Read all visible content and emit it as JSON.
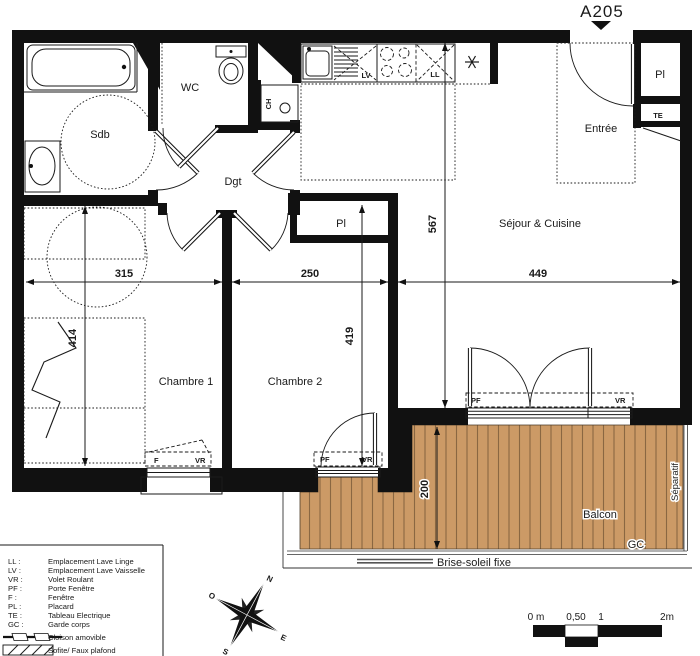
{
  "title": "A205",
  "rooms": {
    "sdb": "Sdb",
    "wc": "WC",
    "dgt": "Dgt",
    "entree": "Entrée",
    "sejour": "Séjour & Cuisine",
    "chambre1": "Chambre 1",
    "chambre2": "Chambre 2",
    "balcon": "Balcon"
  },
  "fixtures": {
    "lv": "LV",
    "ll": "LL",
    "ch": "CH",
    "te": "TE",
    "pl_entrance": "Pl",
    "pl_bedroom": "Pl"
  },
  "openings": {
    "sejour_pf": "PF",
    "sejour_vr": "VR",
    "ch2_pf": "PF",
    "ch2_vr": "VR",
    "ch1_f": "F",
    "ch1_vr": "VR"
  },
  "dims": {
    "w_ch1": "315",
    "w_ch2": "250",
    "w_sejour": "449",
    "h_sejour": "567",
    "h_ch2": "419",
    "h_ch1": "414",
    "d_balcon": "200"
  },
  "balcony": {
    "gc": "GC",
    "separatif": "Séparatif",
    "brise_soleil": "Brise-soleil fixe"
  },
  "legend": {
    "items": [
      {
        "abbr": "LL :",
        "label": "Emplacement  Lave  Linge"
      },
      {
        "abbr": "LV :",
        "label": "Emplacement  Lave  Vaisselle"
      },
      {
        "abbr": "VR :",
        "label": "Volet Roulant"
      },
      {
        "abbr": "PF :",
        "label": "Porte Fenêtre"
      },
      {
        "abbr": "F :",
        "label": "Fenêtre"
      },
      {
        "abbr": "PL :",
        "label": "Placard"
      },
      {
        "abbr": "TE :",
        "label": "Tableau Electrique"
      },
      {
        "abbr": "GC :",
        "label": "Garde corps"
      }
    ],
    "symbols": [
      {
        "label": "Cloison amovible"
      },
      {
        "label": "Sofite/ Faux plafond"
      }
    ]
  },
  "compass": {
    "n": "N",
    "e": "E",
    "s": "S",
    "o": "O"
  },
  "scale": {
    "t0": "0 m",
    "t05": "0,50",
    "t1": "1",
    "t2": "2m"
  },
  "colors": {
    "wall": "#111111",
    "deck": "#cc9a66",
    "deck_line": "#8a6742"
  }
}
